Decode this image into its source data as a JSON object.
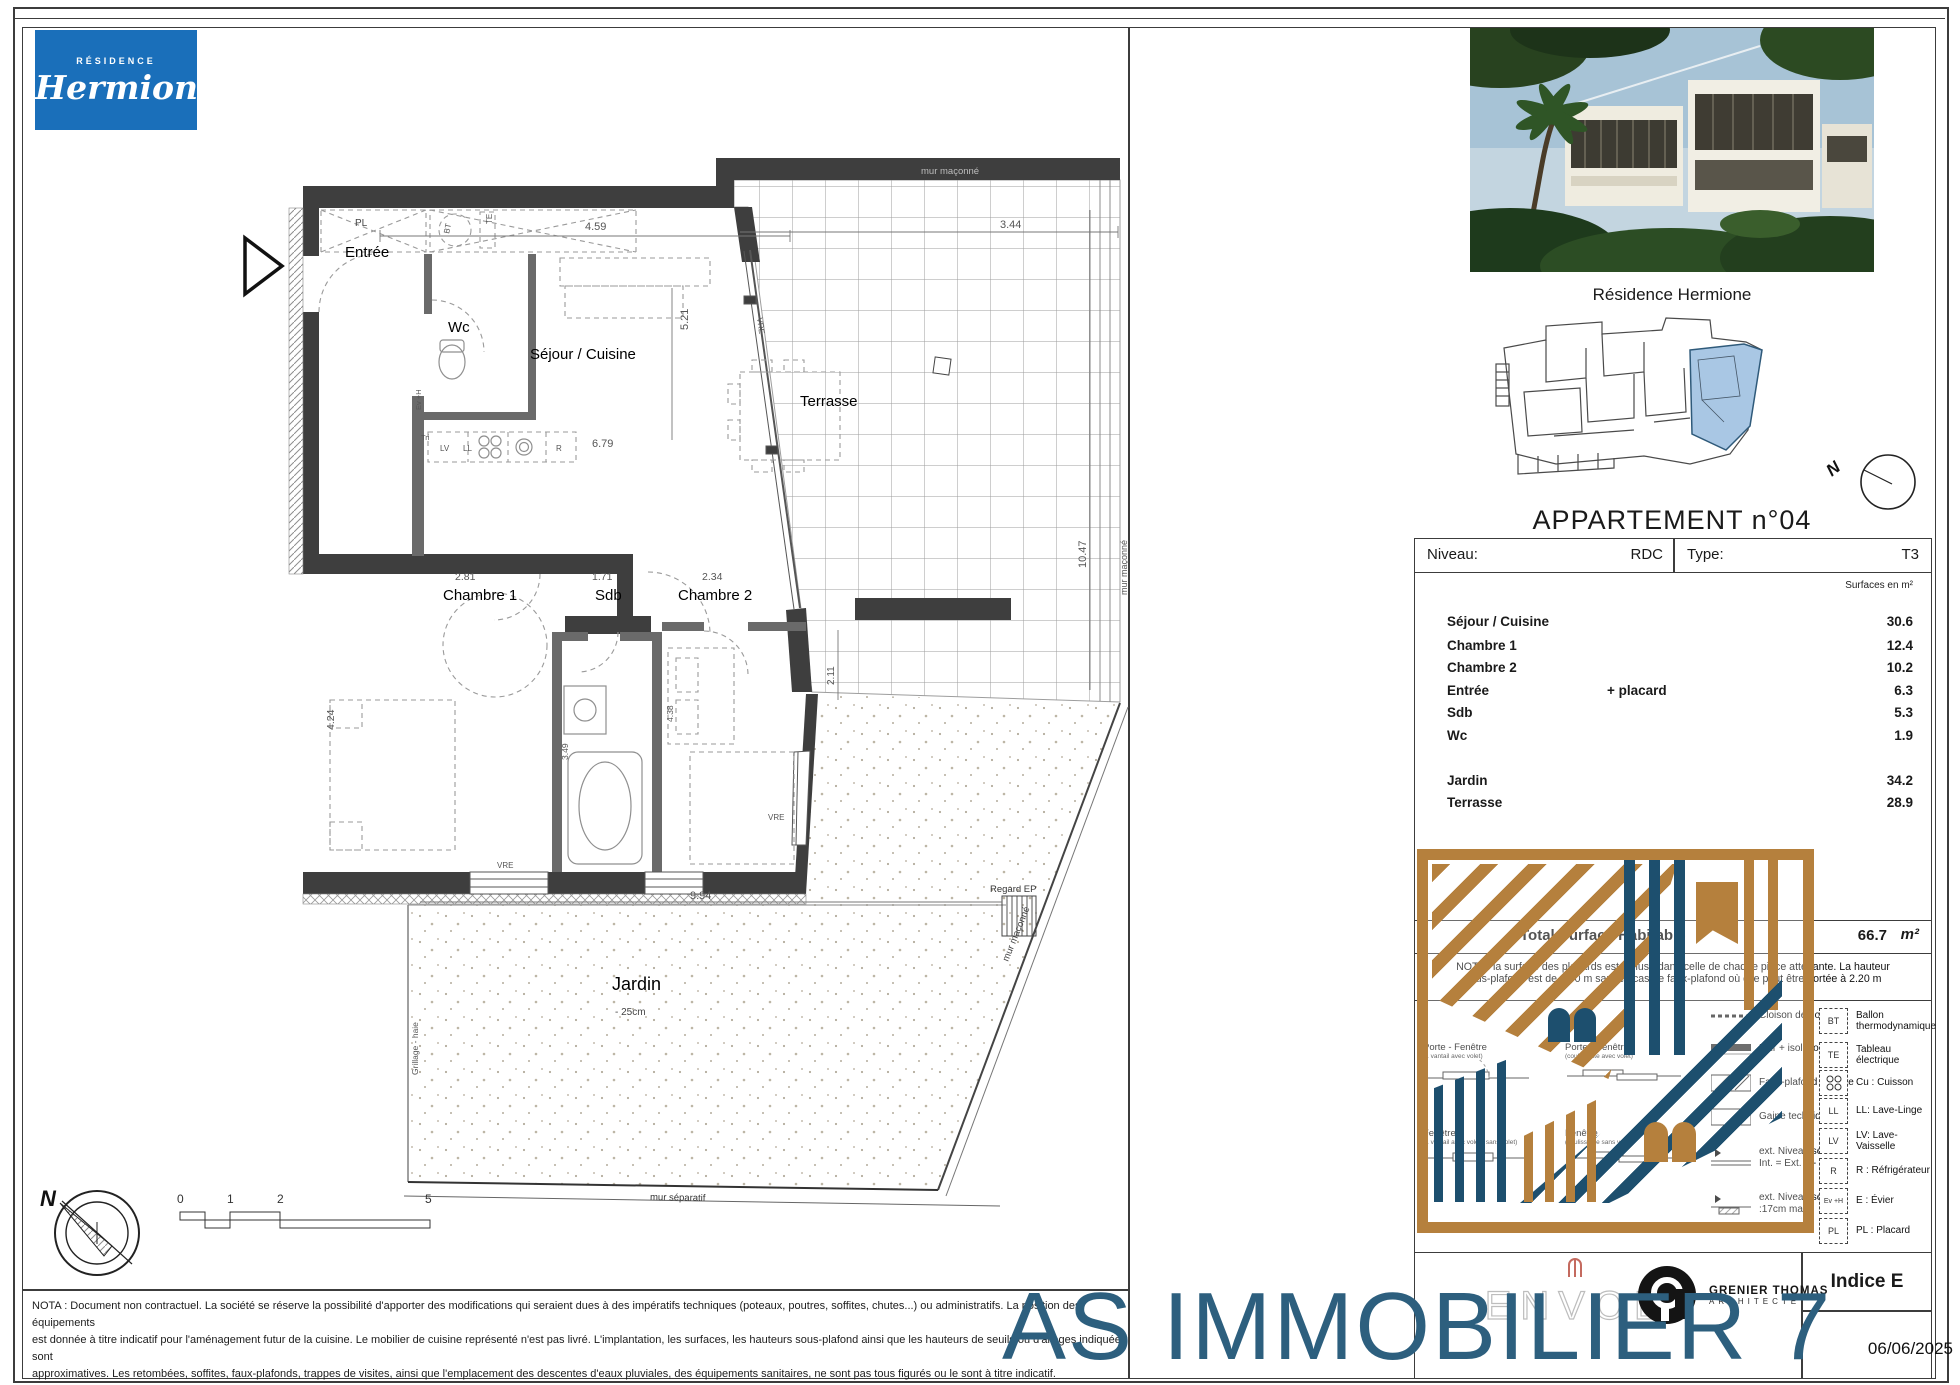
{
  "brand": {
    "top": "RÉSIDENCE",
    "name": "Hermione"
  },
  "plan": {
    "rooms": {
      "entree": "Entrée",
      "wc": "Wc",
      "sejour": "Séjour / Cuisine",
      "terrasse": "Terrasse",
      "chambre1": "Chambre 1",
      "sdb": "Sdb",
      "chambre2": "Chambre 2",
      "jardin": "Jardin"
    },
    "annotations": {
      "pl": "PL",
      "bt": "BT",
      "te": "TE",
      "ev": "Ev +H",
      "tri": "Tri",
      "lv": "LV",
      "ll": "LL",
      "r": "R",
      "vre": "VRE",
      "regard_ep": "Regard EP",
      "jardin_level": "- 25cm",
      "grillage": "Grillage - haie",
      "mur_separatif": "mur séparatif",
      "mur_maconne": "mur maçonné",
      "north": "N"
    },
    "dims": {
      "sejour_w": "4.59",
      "sejour_h": "5.21",
      "cuisine_w": "6.79",
      "terrasse_w": "3.44",
      "terrasse_h": "10.47",
      "terrasse_s": "2.11",
      "ch1_w": "2.81",
      "ch1_h": "4.24",
      "sdb_w": "1.71",
      "sdb_h": "3.49",
      "ch2_w": "2.34",
      "ch2_h": "4.38",
      "jardin_w": "9.94"
    },
    "scale": [
      "0",
      "1",
      "2",
      "5"
    ]
  },
  "panel": {
    "photo_caption": "Résidence Hermione",
    "apartment_title": "APPARTEMENT n°04",
    "level_label": "Niveau:",
    "level_value": "RDC",
    "type_label": "Type:",
    "type_value": "T3",
    "surfaces_unit": "Surfaces en m²",
    "surfaces": [
      {
        "label": "Séjour / Cuisine",
        "extra": "",
        "value": "30.6"
      },
      {
        "label": "Chambre 1",
        "extra": "",
        "value": "12.4"
      },
      {
        "label": "Chambre 2",
        "extra": "",
        "value": "10.2"
      },
      {
        "label": "Entrée",
        "extra": "+ placard",
        "value": "6.3"
      },
      {
        "label": "Sdb",
        "extra": "",
        "value": "5.3"
      },
      {
        "label": "Wc",
        "extra": "",
        "value": "1.9"
      },
      {
        "label": "Jardin",
        "extra": "",
        "value": "34.2"
      },
      {
        "label": "Terrasse",
        "extra": "",
        "value": "28.9"
      }
    ],
    "total_label": "Total Surface Habitable",
    "total_value": "66.7",
    "total_unit": "m²",
    "nota_line1": "NOTA : la surface des placards est incluse dans celle de chaque pièce attenante. La hauteur",
    "nota_line2": "sous-plafond est de 2.50 m sauf en cas de faux-plafond où elle peut être portée à 2.20 m",
    "legend": {
      "right": [
        {
          "code": "BT",
          "label": "Ballon thermodynamique"
        },
        {
          "code": "TE",
          "label": "Tableau électrique"
        },
        {
          "code": "Cu",
          "label": "Cu : Cuisson"
        },
        {
          "code": "LL",
          "label": "LL: Lave-Linge"
        },
        {
          "code": "LV",
          "label": "LV: Lave-Vaisselle"
        },
        {
          "code": "R",
          "label": "R : Réfrigérateur"
        },
        {
          "code": "Ev +H",
          "label": "E : Évier"
        },
        {
          "code": "PL",
          "label": "PL : Placard"
        }
      ],
      "left_symbols": [
        {
          "label": "Cloison démontable"
        },
        {
          "label": "Mur + isolation"
        },
        {
          "label": "Faux-plafond / Soffite"
        },
        {
          "label": "Gaine technique"
        },
        {
          "label": "ext.  Niveau seuil :",
          "sub": "Int. = Ext. +/- 2cm"
        },
        {
          "label": "ext.  Niveau seuil :",
          "sub": ":17cm max."
        }
      ],
      "openings": [
        {
          "title": "Porte - Fenêtre",
          "sub": "(1 vantail avec volet)"
        },
        {
          "title": "Porte - Fenêtre",
          "sub": "(coulissante avec volet)"
        },
        {
          "title": "Fenêtre",
          "sub": "(1 vantail avec volet / sans volet)"
        },
        {
          "title": "Fenêtre",
          "sub": "(coulissante sans volet)"
        }
      ]
    }
  },
  "titleblock": {
    "developer": "ENVOL",
    "architect_name": "GRENIER THOMAS",
    "architect_sub": "ARCHITECTE",
    "indice": "Indice E",
    "date": "06/06/2025"
  },
  "watermark_text": "AS IMMOBILIER 7",
  "footer": {
    "line1": "NOTA : Document non contractuel. La société se réserve la possibilité d'apporter des modifications qui seraient dues à des impératifs techniques (poteaux, poutres, soffites, chutes...) ou administratifs. La position des équipements",
    "line2": "est donnée à titre indicatif pour l'aménagement futur de la cuisine. Le mobilier de cuisine représenté n'est pas livré. L'implantation, les surfaces, les hauteurs sous-plafond ainsi que les hauteurs de seuils ou d'allèges indiquées sont",
    "line3": "approximatives. Les retombées, soffites, faux-plafonds, trappes de visites, ainsi que l'emplacement des descentes d'eaux pluviales, des équipements sanitaires, ne sont pas tous figurés ou le sont à titre indicatif."
  }
}
